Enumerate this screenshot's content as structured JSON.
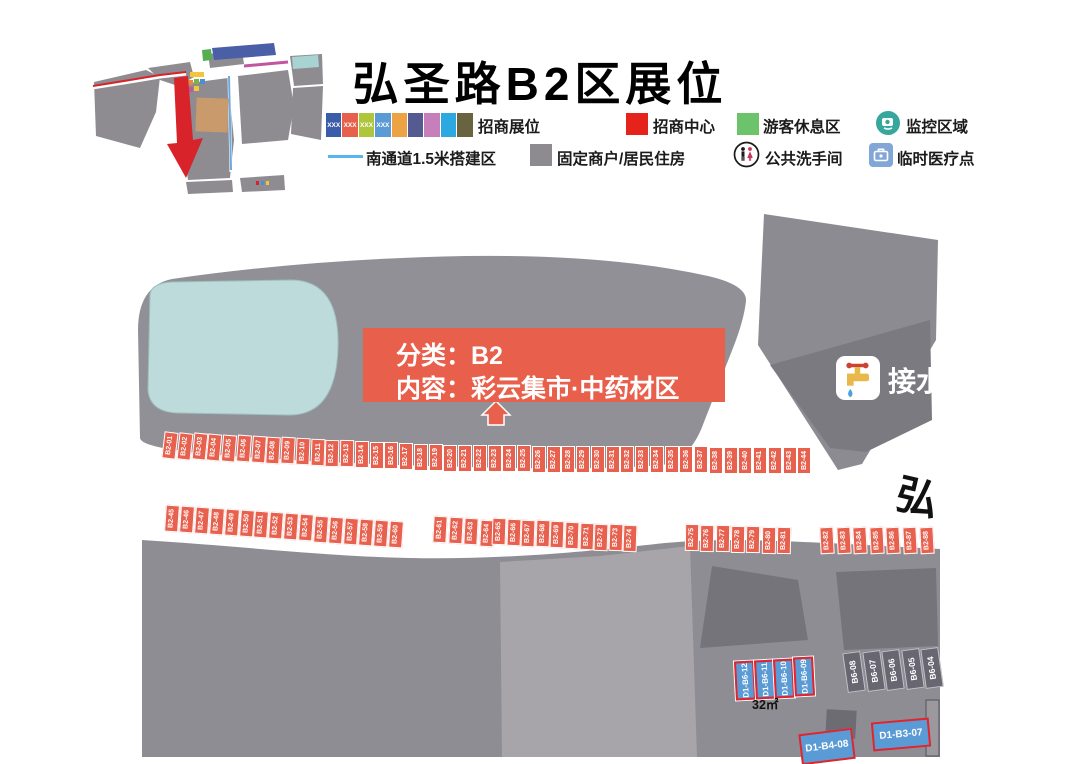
{
  "title": "弘圣路B2区展位",
  "legend": {
    "booth_swatches": {
      "label": "招商展位",
      "xxx_text": "XXX",
      "xxx_count": 4,
      "colors": [
        "#3B5CA8",
        "#E8604C",
        "#AFC63C",
        "#5B9BD5",
        "#EDA343",
        "#555A91",
        "#C77FBC",
        "#2BA9E0",
        "#6A6340"
      ]
    },
    "items": {
      "center": {
        "label": "招商中心",
        "color": "#E5231B"
      },
      "rest": {
        "label": "游客休息区",
        "color": "#6CC46A"
      },
      "monitor": {
        "label": "监控区域",
        "color": "#35A79C"
      },
      "south": {
        "label": "南通道1.5米搭建区",
        "color": "#57B7EC"
      },
      "fixed": {
        "label": "固定商户/居民住房",
        "color": "#8D8B90"
      },
      "toilet": {
        "label": "公共洗手间"
      },
      "medical": {
        "label": "临时医疗点",
        "color": "#82A7D6"
      }
    }
  },
  "callout": {
    "line1": "分类：B2",
    "line2": "内容：彩云集市·中药材区"
  },
  "water_label": "接水",
  "street_label": "弘",
  "booths": {
    "row1": [
      "B2-01",
      "B2-02",
      "B2-03",
      "B2-04",
      "B2-05",
      "B2-06",
      "B2-07",
      "B2-08",
      "B2-09",
      "B2-10",
      "B2-11",
      "B2-12",
      "B2-13",
      "B2-14",
      "B2-15",
      "B2-16",
      "B2-17",
      "B2-18",
      "B2-19",
      "B2-20",
      "B2-21",
      "B2-22",
      "B2-23",
      "B2-24",
      "B2-25",
      "B2-26",
      "B2-27",
      "B2-28",
      "B2-29",
      "B2-30",
      "B2-31",
      "B2-32",
      "B2-33",
      "B2-34",
      "B2-35",
      "B2-36",
      "B2-37",
      "B2-38",
      "B2-39",
      "B2-40",
      "B2-41",
      "B2-42",
      "B2-43",
      "B2-44"
    ],
    "row2_groups": [
      [
        "B2-45",
        "B2-46",
        "B2-47",
        "B2-48",
        "B2-49",
        "B2-50",
        "B2-51",
        "B2-52",
        "B2-53",
        "B2-54",
        "B2-55",
        "B2-56",
        "B2-57",
        "B2-58",
        "B2-59",
        "B2-60"
      ],
      [
        "B2-61",
        "B2-62",
        "B2-63",
        "B2-64"
      ],
      [
        "B2-65",
        "B2-66",
        "B2-67",
        "B2-68",
        "B2-69",
        "B2-70",
        "B2-71",
        "B2-72",
        "B2-73",
        "B2-74"
      ],
      [
        "B2-75",
        "B2-76",
        "B2-77",
        "B2-78",
        "B2-79",
        "B2-80",
        "B2-81"
      ],
      [
        "B2-82",
        "B2-83",
        "B2-84",
        "B2-85",
        "B2-86",
        "B2-87",
        "B2-88"
      ]
    ]
  },
  "bottom": {
    "blue_booths": [
      "D1-B6-12",
      "D1-B6-11",
      "D1-B6-10",
      "D1-B6-09"
    ],
    "area_label": "32㎡",
    "stalls": [
      "B6-08",
      "B6-07",
      "B6-06",
      "B6-05",
      "B6-04"
    ],
    "floating": [
      {
        "label": "D1-B4-08"
      },
      {
        "label": "D1-B3-07"
      }
    ]
  },
  "colors": {
    "booth_red": "#E8614E",
    "callout_red": "#E8604C",
    "blue_booth": "#5B9BD5",
    "blue_booth_border": "#E3242B",
    "stall_gray": "#686670",
    "pond": "#BCDBDA",
    "band_gray": "#929097",
    "arrow_red": "#D8232A"
  }
}
